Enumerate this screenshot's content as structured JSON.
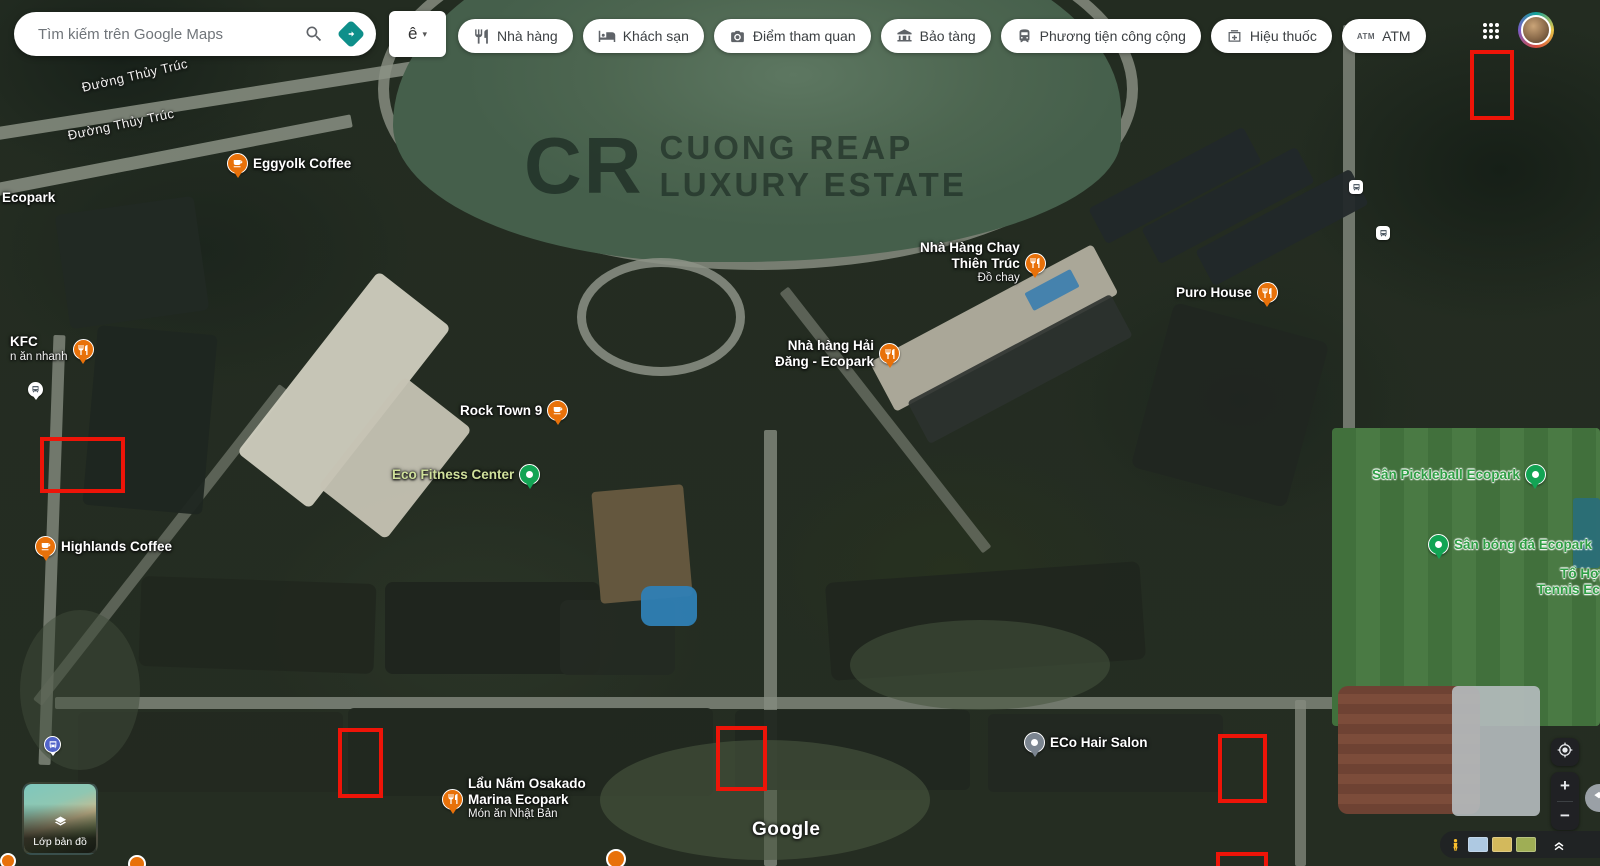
{
  "topbar": {
    "search": {
      "placeholder": "Tìm kiếm trên Google Maps",
      "search_icon": "search-icon",
      "directions_icon": "directions-icon"
    },
    "ime": {
      "label": "ê",
      "caret": "▾"
    },
    "chips": [
      {
        "label": "Nhà hàng",
        "icon": "restaurant-icon"
      },
      {
        "label": "Khách sạn",
        "icon": "hotel-icon"
      },
      {
        "label": "Điểm tham quan",
        "icon": "attraction-icon"
      },
      {
        "label": "Bảo tàng",
        "icon": "museum-icon"
      },
      {
        "label": "Phương tiện công cộng",
        "icon": "transit-icon"
      },
      {
        "label": "Hiệu thuốc",
        "icon": "pharmacy-icon"
      },
      {
        "label": "ATM",
        "icon": "atm-icon"
      }
    ],
    "apps_grid_icon": "apps-grid-icon",
    "avatar_icon": "user-avatar"
  },
  "map": {
    "watermark": {
      "initials": "CR",
      "line1": "CUONG REAP",
      "line2": "LUXURY ESTATE"
    },
    "google_logo": "Google",
    "road_labels": [
      {
        "text": "Đường Thủy Trúc",
        "x": 82,
        "y": 80,
        "rotation": -13
      },
      {
        "text": "Đường Thủy Trúc",
        "x": 68,
        "y": 128,
        "rotation": -12
      }
    ],
    "places": [
      {
        "id": "ecopark-label",
        "lines": [
          "Ecopark"
        ],
        "style": "white",
        "pin": null,
        "x": 2,
        "y": 190
      },
      {
        "id": "eggyolk-coffee",
        "lines": [
          "Eggyolk Coffee"
        ],
        "style": "white",
        "pin": "coffee",
        "pin_side": "left",
        "x": 227,
        "y": 153
      },
      {
        "id": "kfc",
        "lines": [
          "KFC"
        ],
        "sub": "n ăn nhanh",
        "style": "white",
        "pin": "restaurant",
        "pin_side": "right",
        "x": 10,
        "y": 334
      },
      {
        "id": "bus-stop-white",
        "lines": [],
        "pin": "bus-white",
        "pin_side": "left",
        "x": 28,
        "y": 382
      },
      {
        "id": "highlands-coffee",
        "lines": [
          "Highlands Coffee"
        ],
        "style": "white",
        "pin": "coffee",
        "pin_side": "left",
        "x": 35,
        "y": 536
      },
      {
        "id": "rock-town-9",
        "lines": [
          "Rock Town 9"
        ],
        "style": "white",
        "pin": "coffee",
        "pin_side": "right",
        "x": 460,
        "y": 400
      },
      {
        "id": "eco-fitness-center",
        "lines": [
          "Eco Fitness Center"
        ],
        "style": "lime",
        "pin": "green",
        "pin_side": "right",
        "x": 392,
        "y": 464
      },
      {
        "id": "nha-hang-chay-thien-truc",
        "lines": [
          "Nhà Hàng Chay",
          "Thiên Trúc"
        ],
        "sub": "Đồ chay",
        "style": "white",
        "pin": "restaurant",
        "pin_side": "right",
        "align": "right",
        "x": 920,
        "y": 240
      },
      {
        "id": "nha-hang-hai-dang-ecopark",
        "lines": [
          "Nhà hàng Hải",
          "Đăng - Ecopark"
        ],
        "style": "white",
        "pin": "restaurant",
        "pin_side": "right",
        "align": "right",
        "x": 775,
        "y": 338
      },
      {
        "id": "puro-house",
        "lines": [
          "Puro House"
        ],
        "style": "white",
        "pin": "restaurant",
        "pin_side": "right",
        "x": 1176,
        "y": 282
      },
      {
        "id": "san-pickleball-ecopark",
        "lines": [
          "Sân Pickleball Ecopark"
        ],
        "style": "green",
        "pin": "green",
        "pin_side": "right",
        "x": 1372,
        "y": 464
      },
      {
        "id": "san-bong-da-ecopark",
        "lines": [
          "Sân bóng đá Ecopark"
        ],
        "style": "green",
        "pin": "green",
        "pin_side": "left",
        "x": 1428,
        "y": 534
      },
      {
        "id": "to-hop-tennis-ecopark",
        "lines": [
          "Tổ Hợp",
          "Tennis Eco"
        ],
        "style": "green",
        "pin": null,
        "align": "right",
        "x": 1537,
        "y": 566
      },
      {
        "id": "eco-hair-salon",
        "lines": [
          "ECo Hair Salon"
        ],
        "style": "white",
        "pin": "gray",
        "pin_side": "left",
        "x": 1024,
        "y": 732
      },
      {
        "id": "lau-nam-osakado-marina-ecopark",
        "lines": [
          "Lẩu Nấm Osakado",
          "Marina Ecopark"
        ],
        "sub": "Món ăn Nhật Bản",
        "style": "white",
        "pin": "restaurant",
        "pin_side": "left",
        "x": 442,
        "y": 776
      },
      {
        "id": "bus-stop-blue",
        "lines": [],
        "pin": "bus-blue",
        "pin_side": "left",
        "x": 44,
        "y": 736
      }
    ],
    "transit_stops": [
      {
        "x": 1349,
        "y": 180
      },
      {
        "x": 1376,
        "y": 226
      }
    ],
    "partial_pins": [
      {
        "x": 0,
        "y": 853,
        "d": 16
      },
      {
        "x": 128,
        "y": 855,
        "d": 18
      },
      {
        "x": 606,
        "y": 849,
        "d": 20
      }
    ],
    "annotations": [
      {
        "x": 1470,
        "y": 50,
        "w": 44,
        "h": 70
      },
      {
        "x": 40,
        "y": 437,
        "w": 85,
        "h": 56
      },
      {
        "x": 338,
        "y": 728,
        "w": 45,
        "h": 70
      },
      {
        "x": 716,
        "y": 726,
        "w": 51,
        "h": 65
      },
      {
        "x": 1218,
        "y": 734,
        "w": 49,
        "h": 69
      },
      {
        "x": 1216,
        "y": 852,
        "w": 52,
        "h": 22
      }
    ],
    "colors": {
      "poi_orange": "#E8710A",
      "poi_green": "#12A454",
      "annotation_red": "#EE1408",
      "label_green": "#2F9E44",
      "directions_teal": "#0E8F8A"
    }
  },
  "controls": {
    "layers_widget": {
      "label": "Lớp bản đồ",
      "icon": "layers-icon"
    },
    "zoom_in": "+",
    "zoom_out": "−",
    "my_location_icon": "my-location-icon",
    "pegman_icon": "pegman-icon",
    "collapse_icon": "chevron-double-up-icon",
    "imagery_thumbs": [
      "#AEC9E2",
      "#D3B95C",
      "#9FAE55"
    ]
  }
}
